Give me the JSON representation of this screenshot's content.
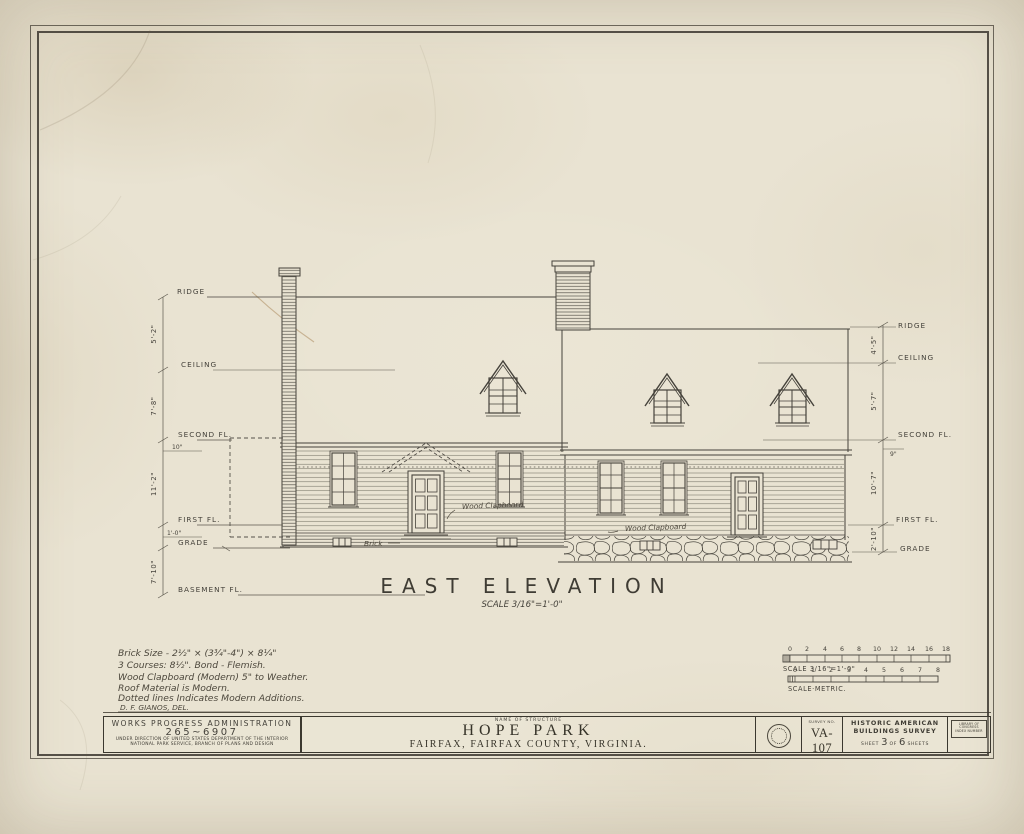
{
  "colors": {
    "paper": "#e9e3d2",
    "ink": "#45423b",
    "ink_light": "#6e6a5f",
    "stain": "#b89a72"
  },
  "drawing": {
    "title": "EAST ELEVATION",
    "scale_note": "SCALE 3/16\"=1'-0\"",
    "levels_left": {
      "ridge": "RIDGE",
      "ceiling": "CEILING",
      "second": "SECOND FL.",
      "first": "FIRST FL.",
      "grade": "GRADE",
      "basement": "BASEMENT FL."
    },
    "dims_left": {
      "a": "5'-2\"",
      "b": "7'-8\"",
      "b2": "10\"",
      "c": "11'-2\"",
      "c2": "1'-0\"",
      "d": "7'-10\""
    },
    "levels_right": {
      "ridge": "RIDGE",
      "ceiling": "CEILING",
      "second": "SECOND FL.",
      "first": "FIRST FL.",
      "grade": "GRADE"
    },
    "dims_right": {
      "a": "4'-5\"",
      "b": "5'-7\"",
      "b2": "9\"",
      "c": "10'-7\"",
      "d": "2'-10\""
    },
    "annotations": {
      "clapboard_left": "Wood Clapboard",
      "clapboard_right": "Wood Clapboard",
      "brick": "Brick"
    }
  },
  "notes": {
    "line1": "Brick Size - 2½\" × (3¾\"-4\") × 8¼\"",
    "line2": "3 Courses: 8½\".  Bond - Flemish.",
    "line3": "Wood Clapboard (Modern) 5\" to Weather.",
    "line4": "Roof Material is Modern.",
    "line5": "Dotted lines Indicates Modern Additions.",
    "delineator": "D. F. GIANOS, DEL."
  },
  "scale_bars": {
    "imperial": {
      "ticks": [
        "0",
        "2",
        "4",
        "6",
        "8",
        "10",
        "12",
        "14",
        "16",
        "18"
      ],
      "label": "SCALE 3/16\"=1'-0\""
    },
    "metric": {
      "ticks": [
        "0",
        "1",
        "2",
        "3",
        "4",
        "5",
        "6",
        "7",
        "8"
      ],
      "label": "SCALE·METRIC."
    }
  },
  "title_block": {
    "wpa": {
      "line1": "WORKS PROGRESS ADMINISTRATION",
      "line2": "265~6907",
      "line3": "UNDER DIRECTION OF UNITED STATES DEPARTMENT OF THE INTERIOR",
      "line4": "NATIONAL PARK SERVICE, BRANCH OF PLANS AND DESIGN"
    },
    "structure": {
      "label": "NAME OF STRUCTURE",
      "name": "HOPE PARK",
      "location": "FAIRFAX, FAIRFAX COUNTY, VIRGINIA."
    },
    "survey": {
      "label": "SURVEY NO.",
      "number": "VA-107"
    },
    "habs": {
      "line1": "HISTORIC AMERICAN",
      "line2": "BUILDINGS SURVEY",
      "sheet_prefix": "SHEET",
      "sheet_no": "3",
      "of_word": "OF",
      "sheet_total": "6",
      "sheets_suffix": "SHEETS"
    },
    "loc": {
      "line1": "LIBRARY OF CONGRESS",
      "line2": "INDEX NUMBER"
    }
  }
}
